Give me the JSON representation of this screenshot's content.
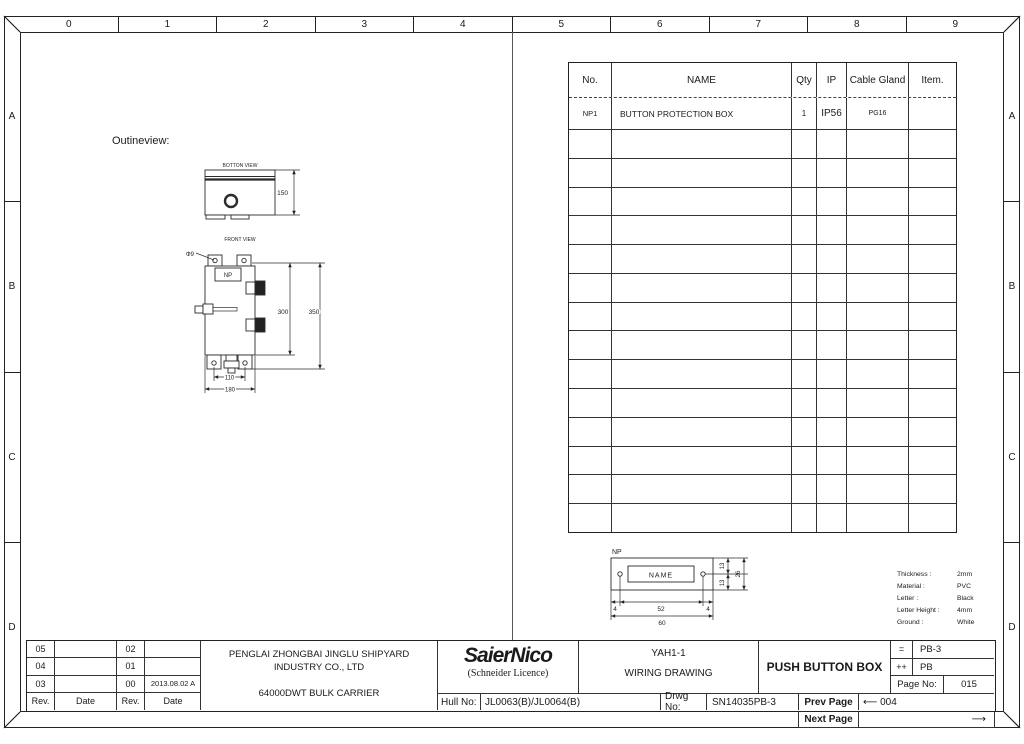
{
  "sheet": {
    "cols": [
      "0",
      "1",
      "2",
      "3",
      "4",
      "5",
      "6",
      "7",
      "8",
      "9"
    ],
    "rows": [
      "A",
      "B",
      "C",
      "D"
    ]
  },
  "outline": {
    "title": "Outineview:",
    "bottom_view": {
      "label": "BOTTON VIEW",
      "dim_height": "150"
    },
    "front_view": {
      "label": "FRONT VIEW",
      "nameplate": "NP",
      "hole_dia": "Φ9",
      "dim_body_height": "300",
      "dim_total_height": "350",
      "dim_feet_spacing": "110",
      "dim_width": "180"
    }
  },
  "parts_table": {
    "headers": [
      "No.",
      "NAME",
      "Qty",
      "IP",
      "Cable Gland",
      "Item."
    ],
    "row": {
      "no": "NP1",
      "name": "BUTTON PROTECTION BOX",
      "qty": "1",
      "ip": "IP56",
      "cable_gland": "PG16",
      "item": ""
    },
    "empty_row_count": 14
  },
  "nameplate": {
    "label": "NP",
    "text": "NAME",
    "dim_left": "4",
    "dim_center": "52",
    "dim_right": "4",
    "dim_total_width": "60",
    "dim_upper": "13",
    "dim_lower": "13",
    "dim_height": "26",
    "notes": [
      {
        "label": "Thickness :",
        "value": "2mm"
      },
      {
        "label": "Material :",
        "value": "PVC"
      },
      {
        "label": "Letter :",
        "value": "Black"
      },
      {
        "label": "Letter Height :",
        "value": "4mm"
      },
      {
        "label": "Ground :",
        "value": "White"
      }
    ]
  },
  "title_block": {
    "revisions": {
      "rows": [
        [
          "05",
          "",
          "02",
          ""
        ],
        [
          "04",
          "",
          "01",
          ""
        ],
        [
          "03",
          "",
          "00",
          "2013.08.02 A"
        ],
        [
          "Rev.",
          "Date",
          "Rev.",
          "Date"
        ]
      ]
    },
    "company_line1": "PENGLAI ZHONGBAI JINGLU SHIPYARD",
    "company_line2": "INDUSTRY CO., LTD",
    "project": "64000DWT BULK CARRIER",
    "logo_name": "SaierNico",
    "logo_subtitle": "(Schneider Licence)",
    "drawing_code": "YAH1-1",
    "drawing_type": "WIRING DRAWING",
    "item_title": "PUSH BUTTON BOX",
    "code_eq_key": "=",
    "code_eq_value": "PB-3",
    "code_pp_key": "++",
    "code_pp_value": "PB",
    "page_label": "Page No:",
    "page_value": "015",
    "hull_label": "Hull No:",
    "hull_value": "JL0063(B)/JL0064(B)",
    "drwg_label": "Drwg No:",
    "drwg_value": "SN14035PB-3",
    "prev_label": "Prev Page",
    "prev_value": "⟵ 004",
    "next_label": "Next Page",
    "next_value": "⟶"
  }
}
